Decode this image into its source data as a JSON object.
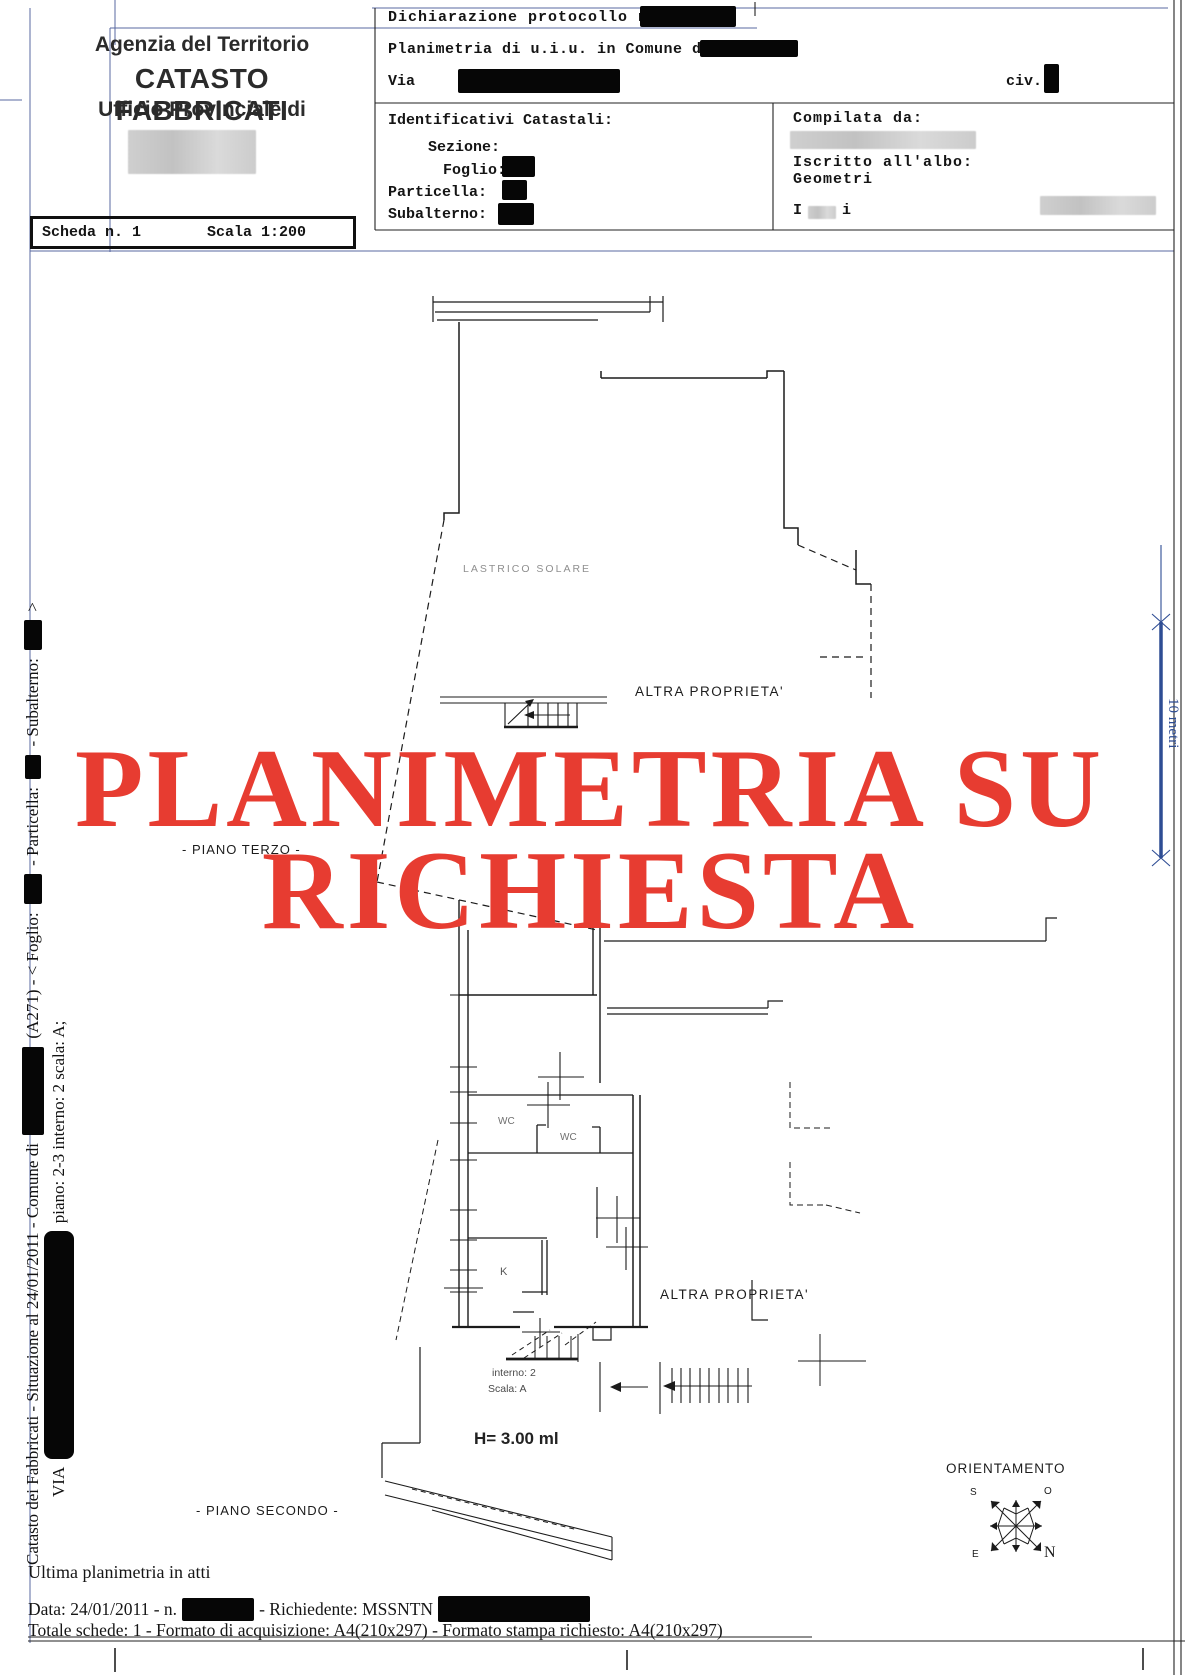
{
  "header": {
    "agency": "Agenzia del Territorio",
    "registry": "CATASTO FABBRICATI",
    "office": "Ufficio Provinciale di",
    "declaration_label": "Dichiarazione protocollo n.",
    "planimetry_label": "Planimetria di u.i.u. in Comune di",
    "street_label": "Via",
    "civic_label": "civ.",
    "cadastral_ids_title": "Identificativi Catastali:",
    "section_label": "Sezione:",
    "sheet_label": "Foglio:",
    "parcel_label": "Particella:",
    "subaltern_label": "Subalterno:",
    "compiled_by_label": "Compilata da:",
    "register_label": "Iscritto all'albo:",
    "register_value": "Geometri",
    "signature_fragment_left": "I",
    "signature_fragment_right": "i"
  },
  "sheet_info": {
    "sheet_number": "Scheda n. 1",
    "scale": "Scala 1:200"
  },
  "plan": {
    "stamp_line1": "PLANIMETRIA SU",
    "stamp_line2": "RICHIESTA",
    "stamp_color": "#e73c31",
    "lastrico_label": "LASTRICO SOLARE",
    "altra_proprieta_upper": "ALTRA PROPRIETA'",
    "altra_proprieta_lower": "ALTRA PROPRIETA'",
    "piano_terzo_label": "- PIANO TERZO -",
    "piano_secondo_label": "- PIANO SECONDO -",
    "wc1": "WC",
    "wc2": "WC",
    "kitchen": "K",
    "interno_label": "interno: 2",
    "scala_label": "Scala: A",
    "height_label": "H= 3.00 ml",
    "orientation_title": "ORIENTAMENTO",
    "compass": {
      "north": "N",
      "south": "S",
      "east": "E",
      "west": "O"
    },
    "scale_bar_label": "10 metri",
    "scale_bar_color": "#2e4d94"
  },
  "side_captions": {
    "line1_part1": "Catasto dei Fabbricati - Situazione al 24/01/2011 - Comune di ",
    "line1_part2": " (A271) - < Foglio: ",
    "line1_part3": " - Particella: ",
    "line1_part4": " - Subalterno: ",
    "line1_part5": " >",
    "line2_part1": "VIA ",
    "line2_part2": " piano: 2-3 interno: 2 scala: A;"
  },
  "footer": {
    "last_plan_note": "Ultima planimetria in atti",
    "date_part1": "Data: 24/01/2011 - n. ",
    "date_part2": " - Richiedente: MSSNTN ",
    "totals_line": "Totale schede: 1 - Formato di acquisizione: A4(210x297)  - Formato stampa richiesto: A4(210x297)"
  }
}
